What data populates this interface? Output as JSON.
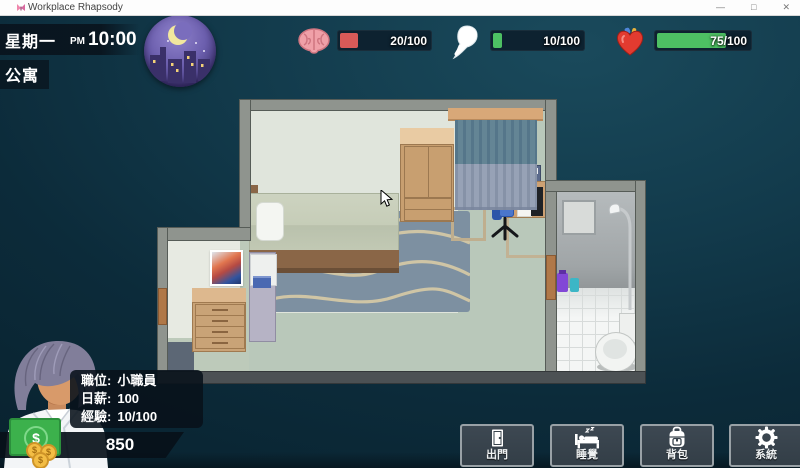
{
  "window": {
    "icon": "butterfly-icon",
    "title": "Workplace Rhapsody",
    "minimize": "—",
    "maximize": "□",
    "close": "✕"
  },
  "hud": {
    "day": "星期一",
    "meridiem": "PM",
    "time": "10:00",
    "location": "公寓",
    "time_of_day_icon": "night-city-moon-icon",
    "stats": [
      {
        "id": "sanity",
        "icon": "brain-icon",
        "value": "20/100",
        "percent": 20,
        "color": "#d85a58"
      },
      {
        "id": "energy",
        "icon": "spirit-icon",
        "value": "10/100",
        "percent": 10,
        "color": "#4dc063"
      },
      {
        "id": "mood",
        "icon": "heart-icon",
        "value": "75/100",
        "percent": 75,
        "color": "#4dc063"
      }
    ]
  },
  "player": {
    "rows": [
      {
        "label": "職位:",
        "value": "小職員"
      },
      {
        "label": "日薪:",
        "value": "100"
      },
      {
        "label": "經驗:",
        "value": "10/100"
      }
    ],
    "money": "850",
    "money_icon": "cash-icon"
  },
  "actions": [
    {
      "id": "go-out",
      "icon": "door-icon",
      "label": "出門"
    },
    {
      "id": "sleep",
      "icon": "bed-icon",
      "label": "睡覺"
    },
    {
      "id": "backpack",
      "icon": "backpack-icon",
      "label": "背包"
    },
    {
      "id": "system",
      "icon": "gear-icon",
      "label": "系統"
    }
  ],
  "scene": {
    "name": "apartment-interior"
  }
}
